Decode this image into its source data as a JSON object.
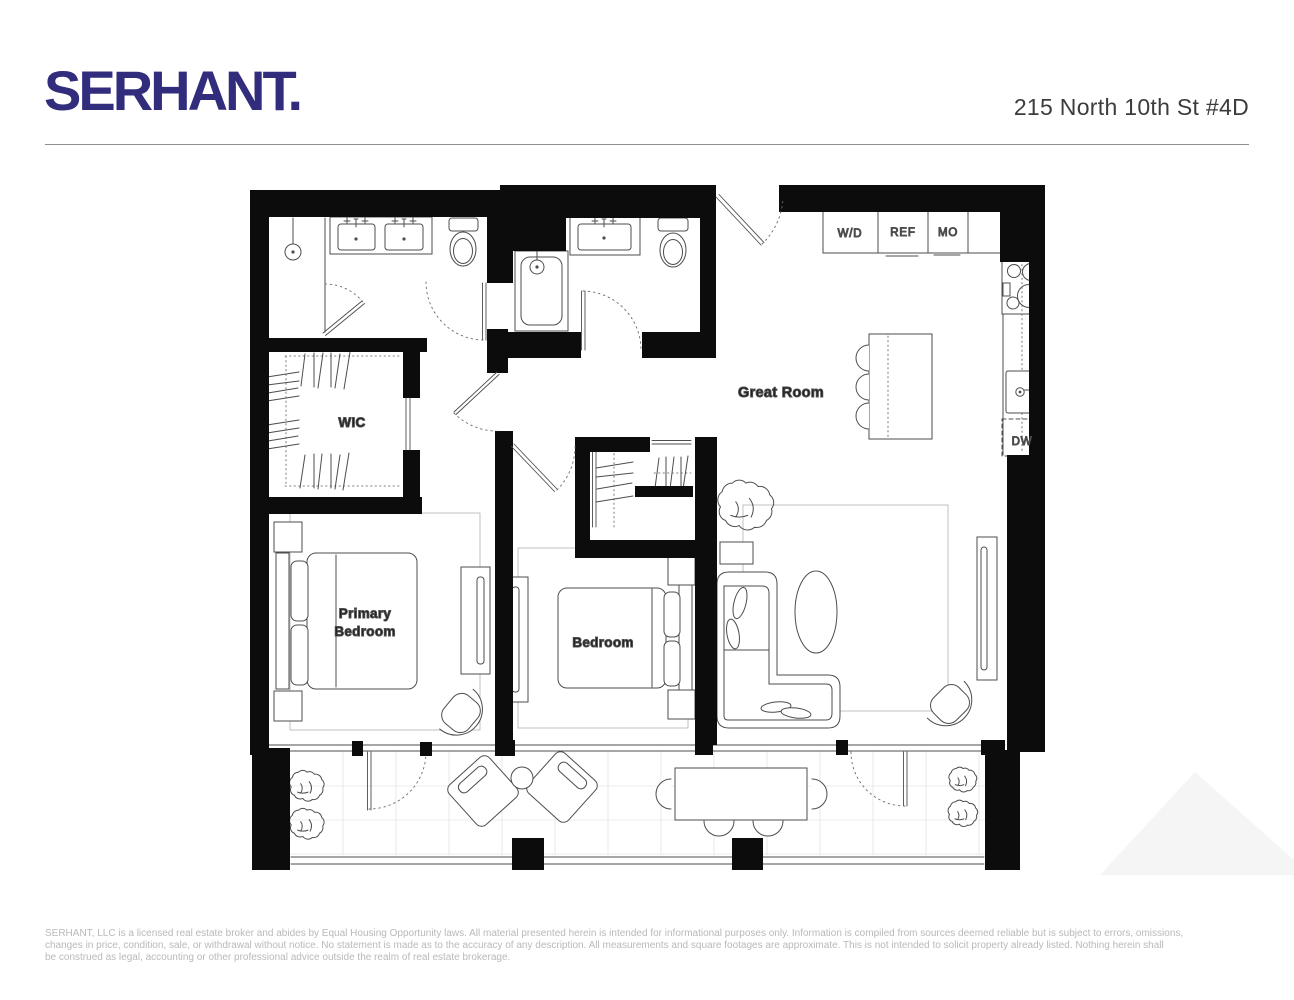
{
  "header": {
    "brand": "SERHANT.",
    "address": "215 North 10th St #4D"
  },
  "floor_plan": {
    "room_labels": {
      "great_room": "Great Room",
      "wic": "WIC",
      "primary_bedroom_line1": "Primary",
      "primary_bedroom_line2": "Bedroom",
      "bedroom": "Bedroom"
    },
    "appliance_labels": {
      "washer_dryer": "W/D",
      "refrigerator": "REF",
      "microwave": "MO",
      "dishwasher": "DW"
    }
  },
  "footer": {
    "line1": "SERHANT, LLC is a licensed real estate broker and abides by Equal Housing Opportunity laws. All material presented herein is intended for informational purposes only. Information is compiled from sources deemed reliable but is subject to errors, omissions,",
    "line2": "changes in price, condition, sale, or withdrawal without notice. No statement is made as to the accuracy of any description. All measurements and square footages are approximate. This is not intended to solicit property already listed. Nothing herein shall",
    "line3": "be construed as legal, accounting or other professional advice outside the realm of real estate brokerage."
  },
  "colors": {
    "brand_navy": "#322c7d",
    "wall_black": "#0c0c0c",
    "fixture_gray": "#4d4d4d",
    "room_label": "#1b1b1b",
    "address_gray": "#3c3c3c",
    "disclaimer_gray": "#b9b9b9",
    "divider_gray": "#909090",
    "tile_grid": "#dcdcdc",
    "watermark": "#f5f5f6"
  }
}
